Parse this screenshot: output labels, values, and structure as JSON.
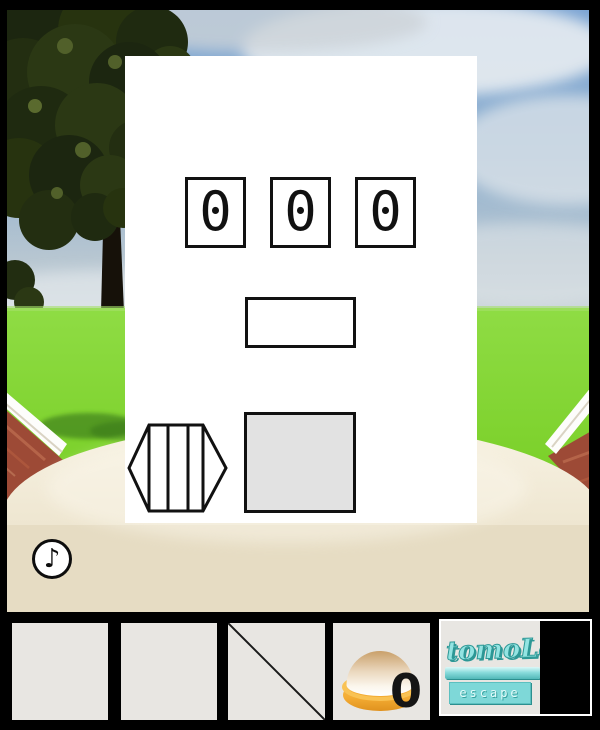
{
  "panel": {
    "digits": [
      "0",
      "0",
      "0"
    ]
  },
  "hud": {
    "music_note": "♪"
  },
  "inventory": {
    "pudding_count": "0"
  },
  "logo": {
    "title": "tomoLa",
    "subtitle": "escape"
  },
  "colors": {
    "logo_teal": "#7ed8d8",
    "grass_green": "#84d838",
    "sky_blue": "#7ba4d3",
    "ground_beige": "#efe8d6",
    "roof_red": "#9d4a36",
    "slot_gray": "#e8e6e2"
  }
}
